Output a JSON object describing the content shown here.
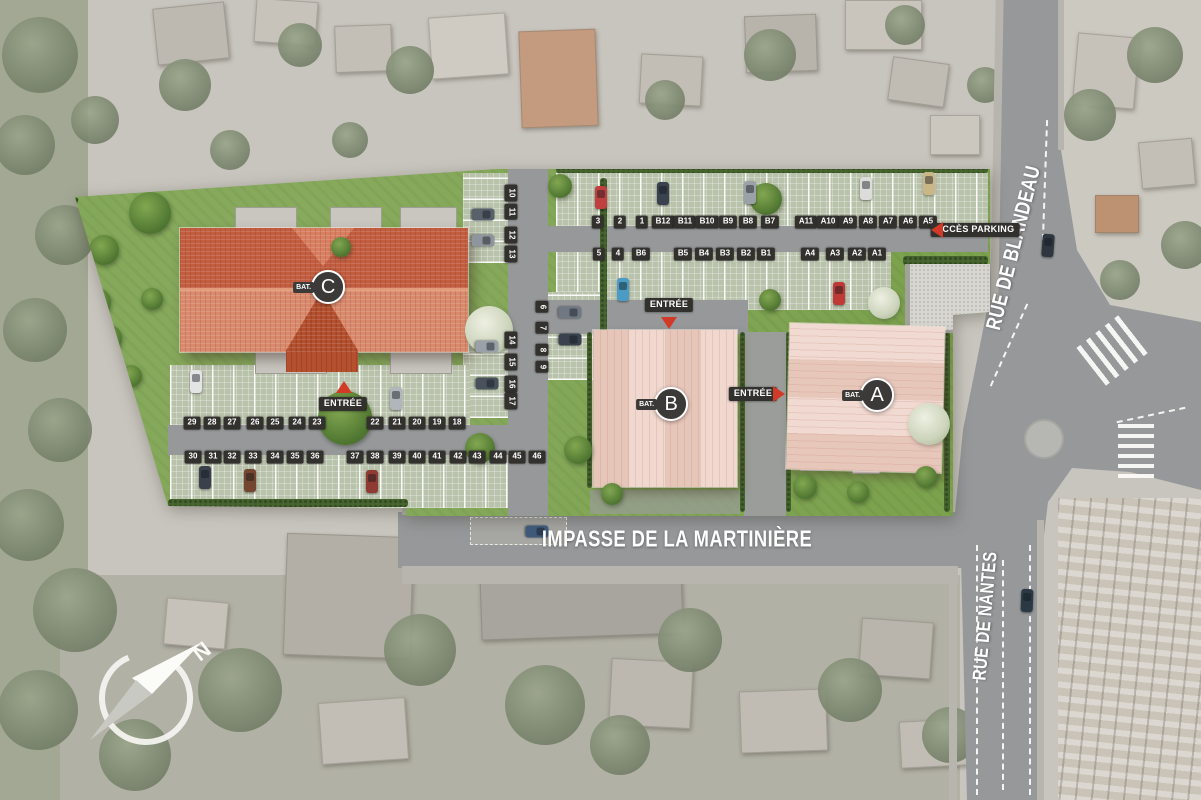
{
  "site_plan": {
    "title": "residence-site-plan",
    "buildings": [
      {
        "letter": "C",
        "tab": "BAT.",
        "x": 322,
        "y": 287
      },
      {
        "letter": "B",
        "tab": "BAT.",
        "x": 665,
        "y": 404
      },
      {
        "letter": "A",
        "tab": "BAT.",
        "x": 871,
        "y": 395
      }
    ],
    "streets": [
      {
        "name": "RUE DE BLANDEAU",
        "x": 1014,
        "y": 248,
        "rot": -76,
        "size": 21
      },
      {
        "name": "IMPASSE DE LA MARTINIÈRE",
        "x": 677,
        "y": 539,
        "rot": 0,
        "size": 23
      },
      {
        "name": "RUE DE NANTES",
        "x": 986,
        "y": 616,
        "rot": -85,
        "size": 19
      }
    ],
    "entrances": [
      {
        "label": "ENTRÉE",
        "x": 343,
        "y": 404,
        "dir": "up",
        "ax": 344,
        "ay": 387
      },
      {
        "label": "ENTRÉE",
        "x": 669,
        "y": 305,
        "dir": "down",
        "ax": 669,
        "ay": 323
      },
      {
        "label": "ENTRÉE",
        "x": 753,
        "y": 394,
        "dir": "right",
        "ax": 779,
        "ay": 394
      }
    ],
    "parking_access": {
      "label": "ACCÈS PARKING",
      "x": 975,
      "y": 230,
      "dir": "left",
      "ax": 937,
      "ay": 230
    },
    "parking_rows": [
      {
        "y": 222,
        "rot": 0,
        "spots": [
          {
            "label": "3",
            "x": 598
          },
          {
            "label": "2",
            "x": 620
          },
          {
            "label": "1",
            "x": 642
          },
          {
            "label": "B12",
            "x": 663
          },
          {
            "label": "B11",
            "x": 685
          },
          {
            "label": "B10",
            "x": 707
          },
          {
            "label": "B9",
            "x": 728
          },
          {
            "label": "B8",
            "x": 748
          },
          {
            "label": "B7",
            "x": 770
          },
          {
            "label": "A11",
            "x": 806
          },
          {
            "label": "A10",
            "x": 828
          },
          {
            "label": "A9",
            "x": 848
          },
          {
            "label": "A8",
            "x": 868
          },
          {
            "label": "A7",
            "x": 888
          },
          {
            "label": "A6",
            "x": 908
          },
          {
            "label": "A5",
            "x": 928
          }
        ]
      },
      {
        "y": 254,
        "rot": 0,
        "spots": [
          {
            "label": "5",
            "x": 599
          },
          {
            "label": "4",
            "x": 618
          },
          {
            "label": "B6",
            "x": 641
          },
          {
            "label": "B5",
            "x": 683
          },
          {
            "label": "B4",
            "x": 704
          },
          {
            "label": "B3",
            "x": 725
          },
          {
            "label": "B2",
            "x": 746
          },
          {
            "label": "B1",
            "x": 766
          },
          {
            "label": "A4",
            "x": 810
          },
          {
            "label": "A3",
            "x": 835
          },
          {
            "label": "A2",
            "x": 857
          },
          {
            "label": "A1",
            "x": 877
          }
        ]
      },
      {
        "x": 511,
        "rot": 90,
        "spots": [
          {
            "label": "10",
            "y": 193
          },
          {
            "label": "11",
            "y": 212
          },
          {
            "label": "12",
            "y": 235
          },
          {
            "label": "13",
            "y": 254
          },
          {
            "label": "14",
            "y": 340
          },
          {
            "label": "15",
            "y": 362
          },
          {
            "label": "16",
            "y": 384
          },
          {
            "label": "17",
            "y": 401
          }
        ]
      },
      {
        "x": 542,
        "rot": 90,
        "spots": [
          {
            "label": "6",
            "y": 307
          },
          {
            "label": "7",
            "y": 328
          },
          {
            "label": "8",
            "y": 350
          },
          {
            "label": "9",
            "y": 367
          }
        ]
      },
      {
        "y": 423,
        "rot": 0,
        "spots": [
          {
            "label": "29",
            "x": 192
          },
          {
            "label": "28",
            "x": 212
          },
          {
            "label": "27",
            "x": 232
          },
          {
            "label": "26",
            "x": 255
          },
          {
            "label": "25",
            "x": 275
          },
          {
            "label": "24",
            "x": 297
          },
          {
            "label": "23",
            "x": 317
          },
          {
            "label": "22",
            "x": 375
          },
          {
            "label": "21",
            "x": 397
          },
          {
            "label": "20",
            "x": 417
          },
          {
            "label": "19",
            "x": 437
          },
          {
            "label": "18",
            "x": 457
          }
        ]
      },
      {
        "y": 457,
        "rot": 0,
        "spots": [
          {
            "label": "30",
            "x": 193
          },
          {
            "label": "31",
            "x": 213
          },
          {
            "label": "32",
            "x": 232
          },
          {
            "label": "33",
            "x": 253
          },
          {
            "label": "34",
            "x": 275
          },
          {
            "label": "35",
            "x": 295
          },
          {
            "label": "36",
            "x": 315
          },
          {
            "label": "37",
            "x": 355
          },
          {
            "label": "38",
            "x": 375
          },
          {
            "label": "39",
            "x": 397
          },
          {
            "label": "40",
            "x": 417
          },
          {
            "label": "41",
            "x": 437
          },
          {
            "label": "42",
            "x": 458
          },
          {
            "label": "43",
            "x": 477
          },
          {
            "label": "44",
            "x": 498
          },
          {
            "label": "45",
            "x": 517
          },
          {
            "label": "46",
            "x": 537
          }
        ]
      }
    ],
    "compass": {
      "north_label": "N"
    },
    "colors": {
      "accent_red": "#d23a28",
      "roof_c_dark": "#c25d40",
      "roof_c_light": "#d98a6c",
      "roof_ab": "#ecd0c6",
      "lawn": "#7ca24e",
      "paver": "#b9c2aa",
      "road": "#96989a",
      "label_chip": "#32312d"
    }
  }
}
